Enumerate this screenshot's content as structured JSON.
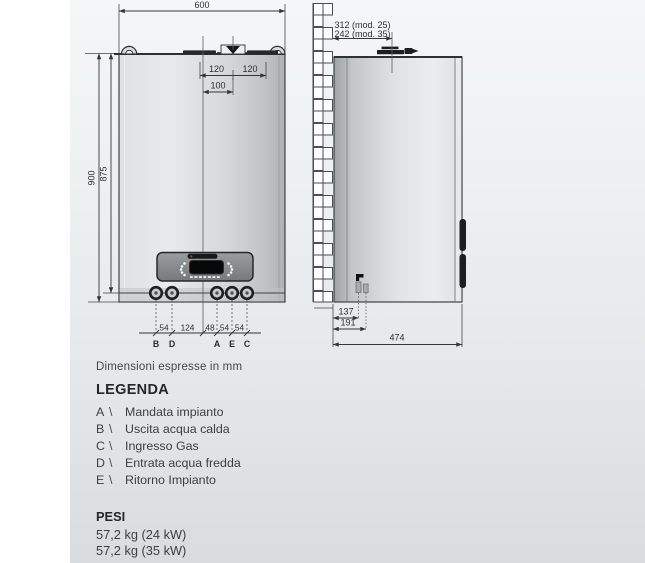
{
  "note": "Dimensioni espresse in mm",
  "diagram": {
    "front": {
      "width": "600",
      "flue_left": "120",
      "flue_right": "120",
      "flue_center": "100",
      "height_total": "900",
      "height_body": "875",
      "spacing": [
        "54",
        "124",
        "48",
        "54",
        "54"
      ],
      "ports": [
        "B",
        "D",
        "A",
        "E",
        "C"
      ]
    },
    "side": {
      "depth_mod25": "312 (mod. 25)",
      "depth_mod35": "242 (mod. 35)",
      "gas_offset_1": "137",
      "gas_offset_2": "191",
      "depth_total": "474"
    }
  },
  "legend": {
    "title": "LEGENDA",
    "separator": "\\",
    "items": [
      {
        "key": "A",
        "label": "Mandata impianto"
      },
      {
        "key": "B",
        "label": "Uscita acqua calda"
      },
      {
        "key": "C",
        "label": "Ingresso Gas"
      },
      {
        "key": "D",
        "label": "Entrata acqua fredda"
      },
      {
        "key": "E",
        "label": "Ritorno Impianto"
      }
    ]
  },
  "weights": {
    "title": "PESI",
    "items": [
      "57,2 kg (24 kW)",
      "57,2 kg (35 kW)"
    ]
  }
}
